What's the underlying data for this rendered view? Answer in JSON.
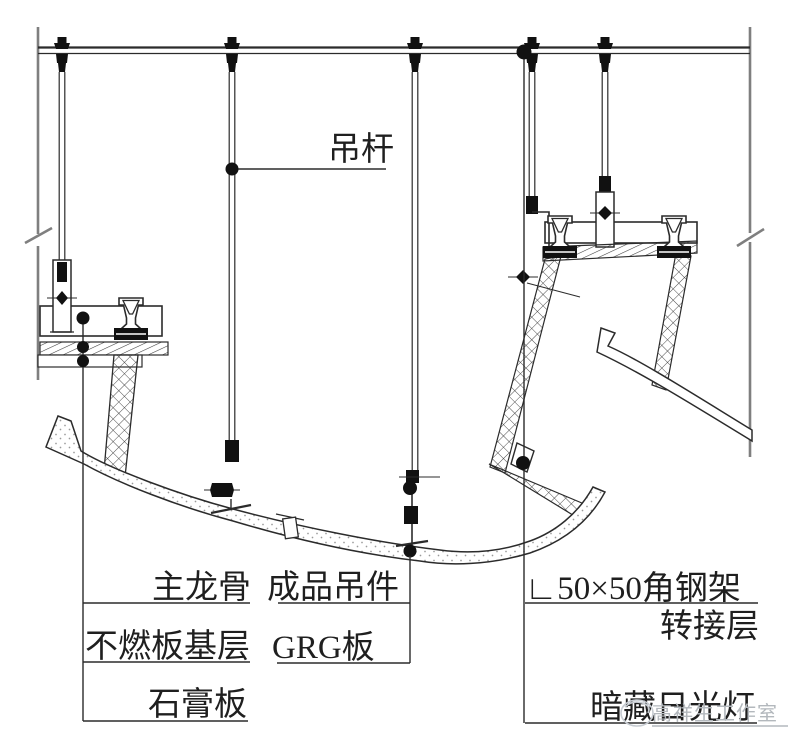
{
  "drawing": {
    "type": "ceiling-suspension-construction-detail",
    "labels": {
      "hanger_rod": "吊杆",
      "main_keel": "主龙骨",
      "finished_hanger": "成品吊件",
      "noncombustible_base": "不燃板基层",
      "grg_panel": "GRG板",
      "gypsum_board": "石膏板",
      "angle_steel_frame": "∟50×50角钢架",
      "transfer_layer": "转接层",
      "concealed_fluorescent_light": "暗藏日光灯"
    },
    "watermark": "高祥生工作室",
    "colors": {
      "line": "#2b2b2b",
      "boundary_line": "#7f7f7f",
      "hatch": "#3a3a3a",
      "stipple": "#9a9a9a",
      "watermark": "#b3b8bd",
      "paper": "#ffffff"
    }
  }
}
